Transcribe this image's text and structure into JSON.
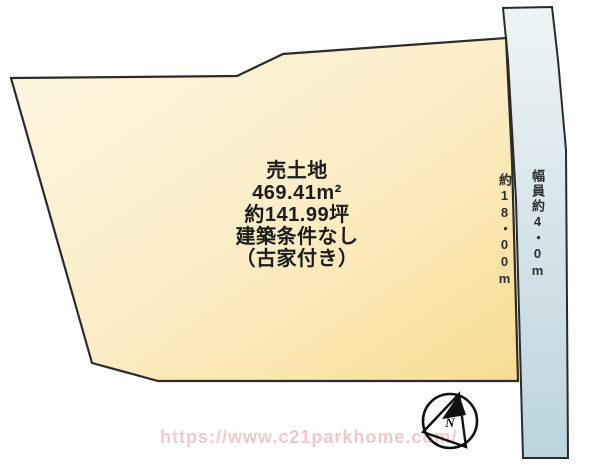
{
  "plot": {
    "title": "売土地",
    "area_m2": "469.41m²",
    "area_tsubo": "約141.99坪",
    "building_condition": "建築条件なし",
    "note": "（古家付き）",
    "depth_label": "約18・00m"
  },
  "road": {
    "width_label": "幅員約4・0m"
  },
  "compass": {
    "label": "N"
  },
  "watermark": {
    "text": "https://www.c21parkhome.com/"
  },
  "colors": {
    "background": "#ffffff",
    "outline": "#2b2b2b",
    "plot_fill_light": "#fdf6e3",
    "plot_fill_dark": "#f7dc92",
    "road_fill_light": "#eef4f6",
    "road_fill_dark": "#bcd4dc",
    "label_text": "#1c1c1c",
    "compass_ink": "#111111",
    "watermark_pink": "#eebcbc"
  }
}
